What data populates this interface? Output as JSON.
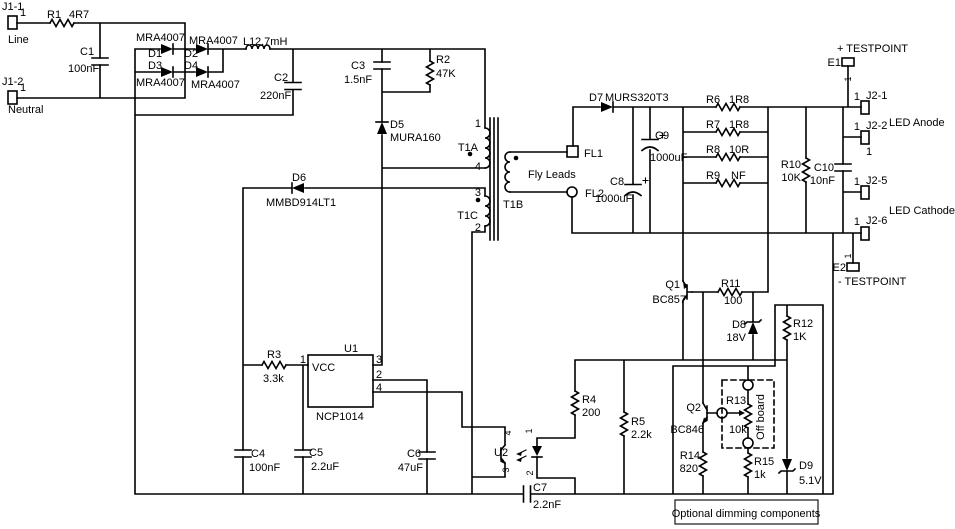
{
  "components": {
    "r1": {
      "ref": "R1",
      "value": "4R7"
    },
    "c1": {
      "ref": "C1",
      "value": "100nF"
    },
    "d1": {
      "ref": "D1",
      "value": "MRA4007"
    },
    "d2": {
      "ref": "D2",
      "value": "MRA4007"
    },
    "d3": {
      "ref": "D3",
      "value": "MRA4007"
    },
    "d4": {
      "ref": "D4",
      "value": "MRA4007"
    },
    "l1": {
      "ref": "L1",
      "value": "2.7mH"
    },
    "c2": {
      "ref": "C2",
      "value": "220nF"
    },
    "c3": {
      "ref": "C3",
      "value": "1.5nF"
    },
    "r2": {
      "ref": "R2",
      "value": "47K"
    },
    "d5": {
      "ref": "D5",
      "value": "MURA160"
    },
    "d6": {
      "ref": "D6",
      "value": "MMBD914LT1"
    },
    "d7": {
      "ref": "D7",
      "value": "MURS320T3"
    },
    "c8": {
      "ref": "C8",
      "value": "1000uF"
    },
    "c9": {
      "ref": "C9",
      "value": "1000uF"
    },
    "r6": {
      "ref": "R6",
      "value": "1R8"
    },
    "r7": {
      "ref": "R7",
      "value": "1R8"
    },
    "r8": {
      "ref": "R8",
      "value": "10R"
    },
    "r9": {
      "ref": "R9",
      "value": "NF"
    },
    "r10": {
      "ref": "R10",
      "value": "10K"
    },
    "c10": {
      "ref": "C10",
      "value": "10nF"
    },
    "q1": {
      "ref": "Q1",
      "value": "BC857"
    },
    "r11": {
      "ref": "R11",
      "value": "100"
    },
    "d8": {
      "ref": "D8",
      "value": "18V"
    },
    "r12": {
      "ref": "R12",
      "value": "1K"
    },
    "q2": {
      "ref": "Q2",
      "value": "BC846"
    },
    "r13": {
      "ref": "R13",
      "value": "10k"
    },
    "r14": {
      "ref": "R14",
      "value": "820"
    },
    "r15": {
      "ref": "R15",
      "value": "1k"
    },
    "d9": {
      "ref": "D9",
      "value": "5.1V"
    },
    "r4": {
      "ref": "R4",
      "value": "200"
    },
    "r5": {
      "ref": "R5",
      "value": "2.2k"
    },
    "r3": {
      "ref": "R3",
      "value": "3.3k"
    },
    "c4": {
      "ref": "C4",
      "value": "100nF"
    },
    "c5": {
      "ref": "C5",
      "value": "2.2uF"
    },
    "c6": {
      "ref": "C6",
      "value": "47uF"
    },
    "c7": {
      "ref": "C7",
      "value": "2.2nF"
    },
    "u1": {
      "ref": "U1",
      "value": "NCP1014",
      "pin_label": "VCC",
      "pins": [
        "1",
        "3",
        "2",
        "4"
      ]
    },
    "u2": {
      "ref": "U2",
      "pins": [
        "1",
        "2",
        "3",
        "4"
      ]
    },
    "t1a": {
      "ref": "T1A",
      "pins": [
        "1",
        "4"
      ]
    },
    "t1b": {
      "ref": "T1B"
    },
    "t1c": {
      "ref": "T1C",
      "pins": [
        "3",
        "2"
      ]
    }
  },
  "connectors": {
    "j1_1": {
      "ref": "J1-1",
      "pin": "1",
      "label": "Line"
    },
    "j1_2": {
      "ref": "J1-2",
      "pin": "1",
      "label": "Neutral"
    },
    "j2_1": {
      "ref": "J2-1",
      "pin": "1"
    },
    "j2_2": {
      "ref": "J2-2",
      "pin": "1",
      "pin2": "1"
    },
    "j2_5": {
      "ref": "J2-5",
      "pin": "1"
    },
    "j2_6": {
      "ref": "J2-6",
      "pin": "1"
    },
    "fl1": {
      "ref": "FL1"
    },
    "fl2": {
      "ref": "FL2"
    }
  },
  "testpoints": {
    "e1": {
      "ref": "E1",
      "pin": "1",
      "label": "+ TESTPOINT"
    },
    "e2": {
      "ref": "E2",
      "pin": "1",
      "label": "- TESTPOINT"
    }
  },
  "annotations": {
    "led_anode": "LED Anode",
    "led_cathode": "LED Cathode",
    "fly_leads": "Fly Leads",
    "off_board": "Off board",
    "dimming_box": "Optional dimming components"
  }
}
